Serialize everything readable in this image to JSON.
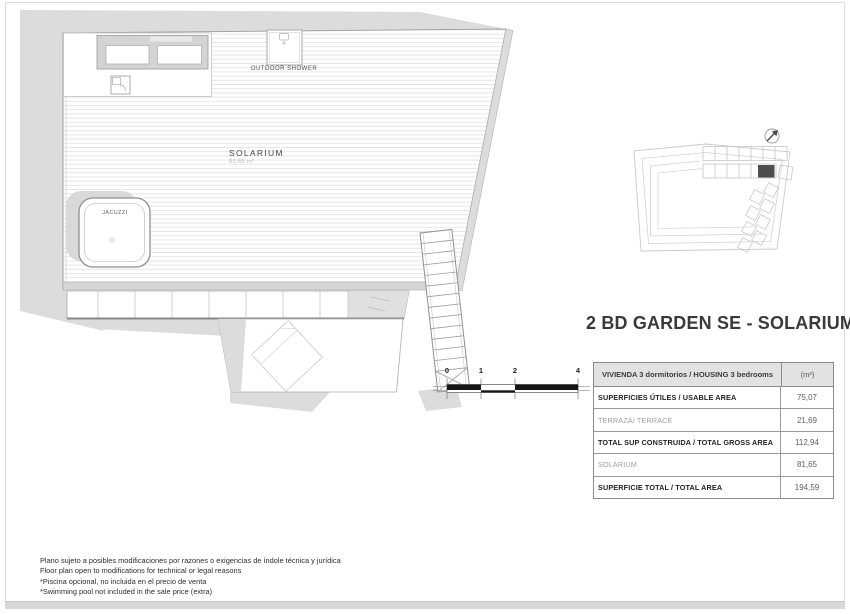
{
  "sheet": {
    "title": "2 BD GARDEN SE - SOLARIUM"
  },
  "plan": {
    "labels": {
      "outdoor_shower": "OUTDOOR SHOWER",
      "solarium": "SOLARIUM",
      "solarium_area": "81,65 m²",
      "jacuzzi": "JACUZZI"
    },
    "scale_ticks": [
      "0",
      "1",
      "2",
      "4"
    ]
  },
  "table": {
    "header": {
      "label": "VIVIENDA 3 dormitorios / HOUSING 3 bedrooms",
      "unit": "(m²)"
    },
    "rows": [
      {
        "label": "SUPERFICIES ÚTILES / USABLE AREA",
        "value": "75,07",
        "style": "bold"
      },
      {
        "label": "TERRAZA/ TERRACE",
        "value": "21,69",
        "style": "light"
      },
      {
        "label": "TOTAL SUP CONSTRUIDA / TOTAL GROSS AREA",
        "value": "112,94",
        "style": "bold"
      },
      {
        "label": "SOLARIUM",
        "value": "81,65",
        "style": "light"
      },
      {
        "label": "SUPERFICIE TOTAL / TOTAL  AREA",
        "value": "194,59",
        "style": "bold"
      }
    ]
  },
  "disclaimer": {
    "lines": [
      "Plano sujeto a posibles modificaciones por razones o exigencias de índole técnica y jurídica",
      "Floor plan open to modifications for technical or legal reasons",
      "*Piscina opcional, no incluida en el precio de venta",
      "*Swimming pool not included in the sale price (extra)"
    ]
  },
  "colors": {
    "shadow": "#dcdcdc",
    "wall_line": "#a2a2a2",
    "deck_stripe": "#e6e6e6",
    "highlight_unit": "#4d4d4d",
    "table_header_bg": "#e2e2e2",
    "scale_black": "#161616"
  }
}
